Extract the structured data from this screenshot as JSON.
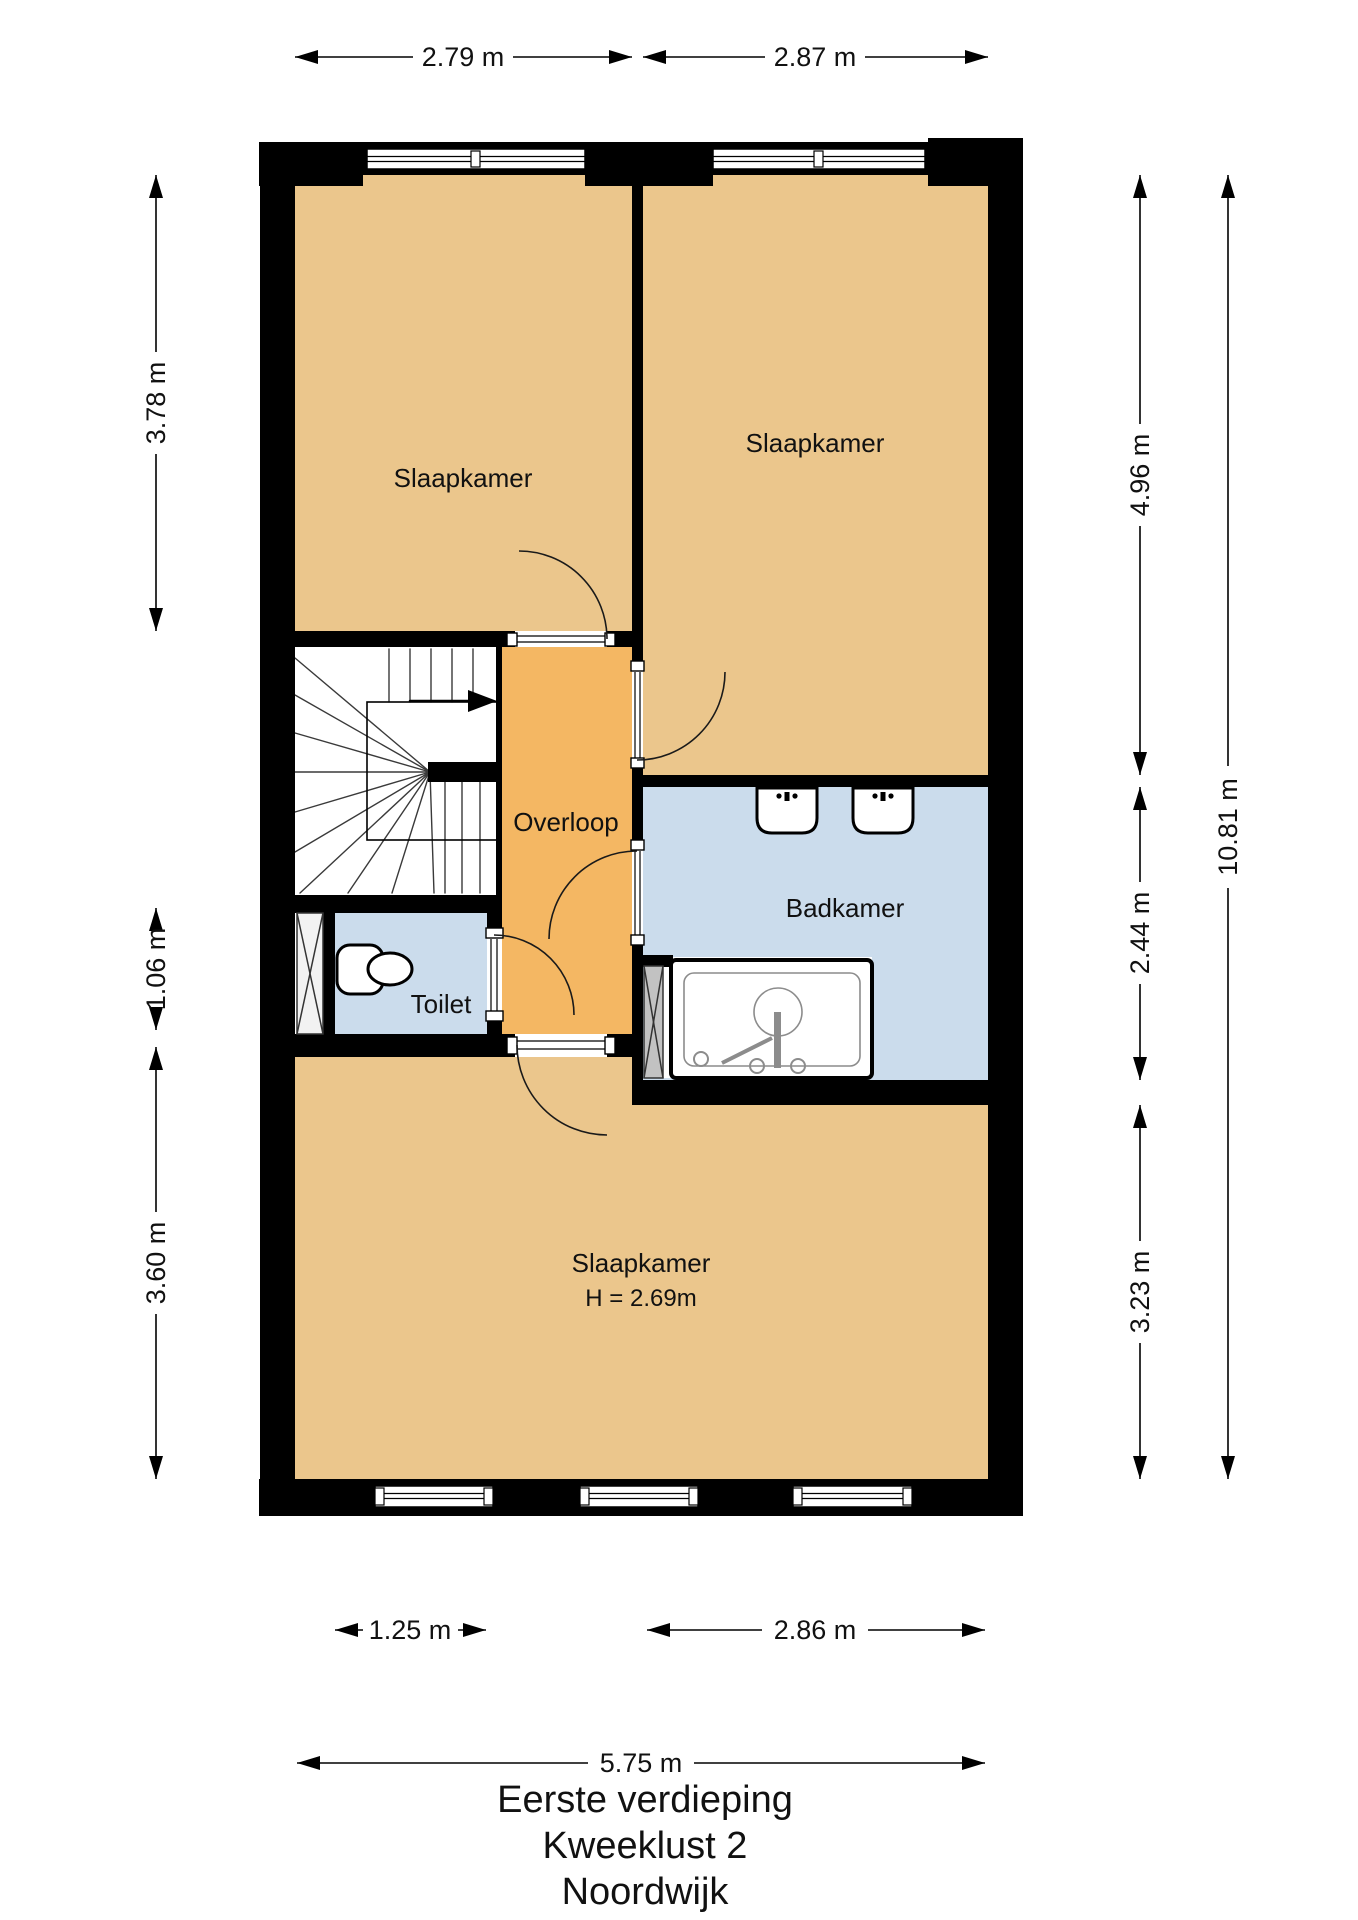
{
  "title": {
    "line1": "Eerste verdieping",
    "line2": "Kweeklust 2",
    "line3": "Noordwijk"
  },
  "rooms": {
    "slaapkamer_tl": {
      "label": "Slaapkamer"
    },
    "slaapkamer_tr": {
      "label": "Slaapkamer"
    },
    "slaapkamer_bottom": {
      "label": "Slaapkamer",
      "height_note": "H = 2.69m"
    },
    "overloop": {
      "label": "Overloop"
    },
    "badkamer": {
      "label": "Badkamer"
    },
    "toilet": {
      "label": "Toilet"
    }
  },
  "dimensions": {
    "top": [
      {
        "label": "2.79 m"
      },
      {
        "label": "2.87 m"
      }
    ],
    "left": [
      {
        "label": "3.78 m"
      },
      {
        "label": "1.06 m"
      },
      {
        "label": "3.60 m"
      }
    ],
    "right_inner": [
      {
        "label": "4.96 m"
      },
      {
        "label": "2.44 m"
      },
      {
        "label": "3.23 m"
      }
    ],
    "right_outer": {
      "label": "10.81 m"
    },
    "bottom_inner": [
      {
        "label": "1.25 m"
      },
      {
        "label": "2.86 m"
      }
    ],
    "bottom_outer": {
      "label": "5.75 m"
    }
  },
  "colors": {
    "wall": "#000000",
    "bedroom_floor": "#EBC68C",
    "landing_floor": "#F4B763",
    "wet_floor": "#CBDCEC",
    "shaft_light": "#F2F2F2",
    "shaft_dark": "#C2C2C2",
    "fixture_line": "#8C8C8C",
    "stair_line": "#3A3A3A"
  }
}
